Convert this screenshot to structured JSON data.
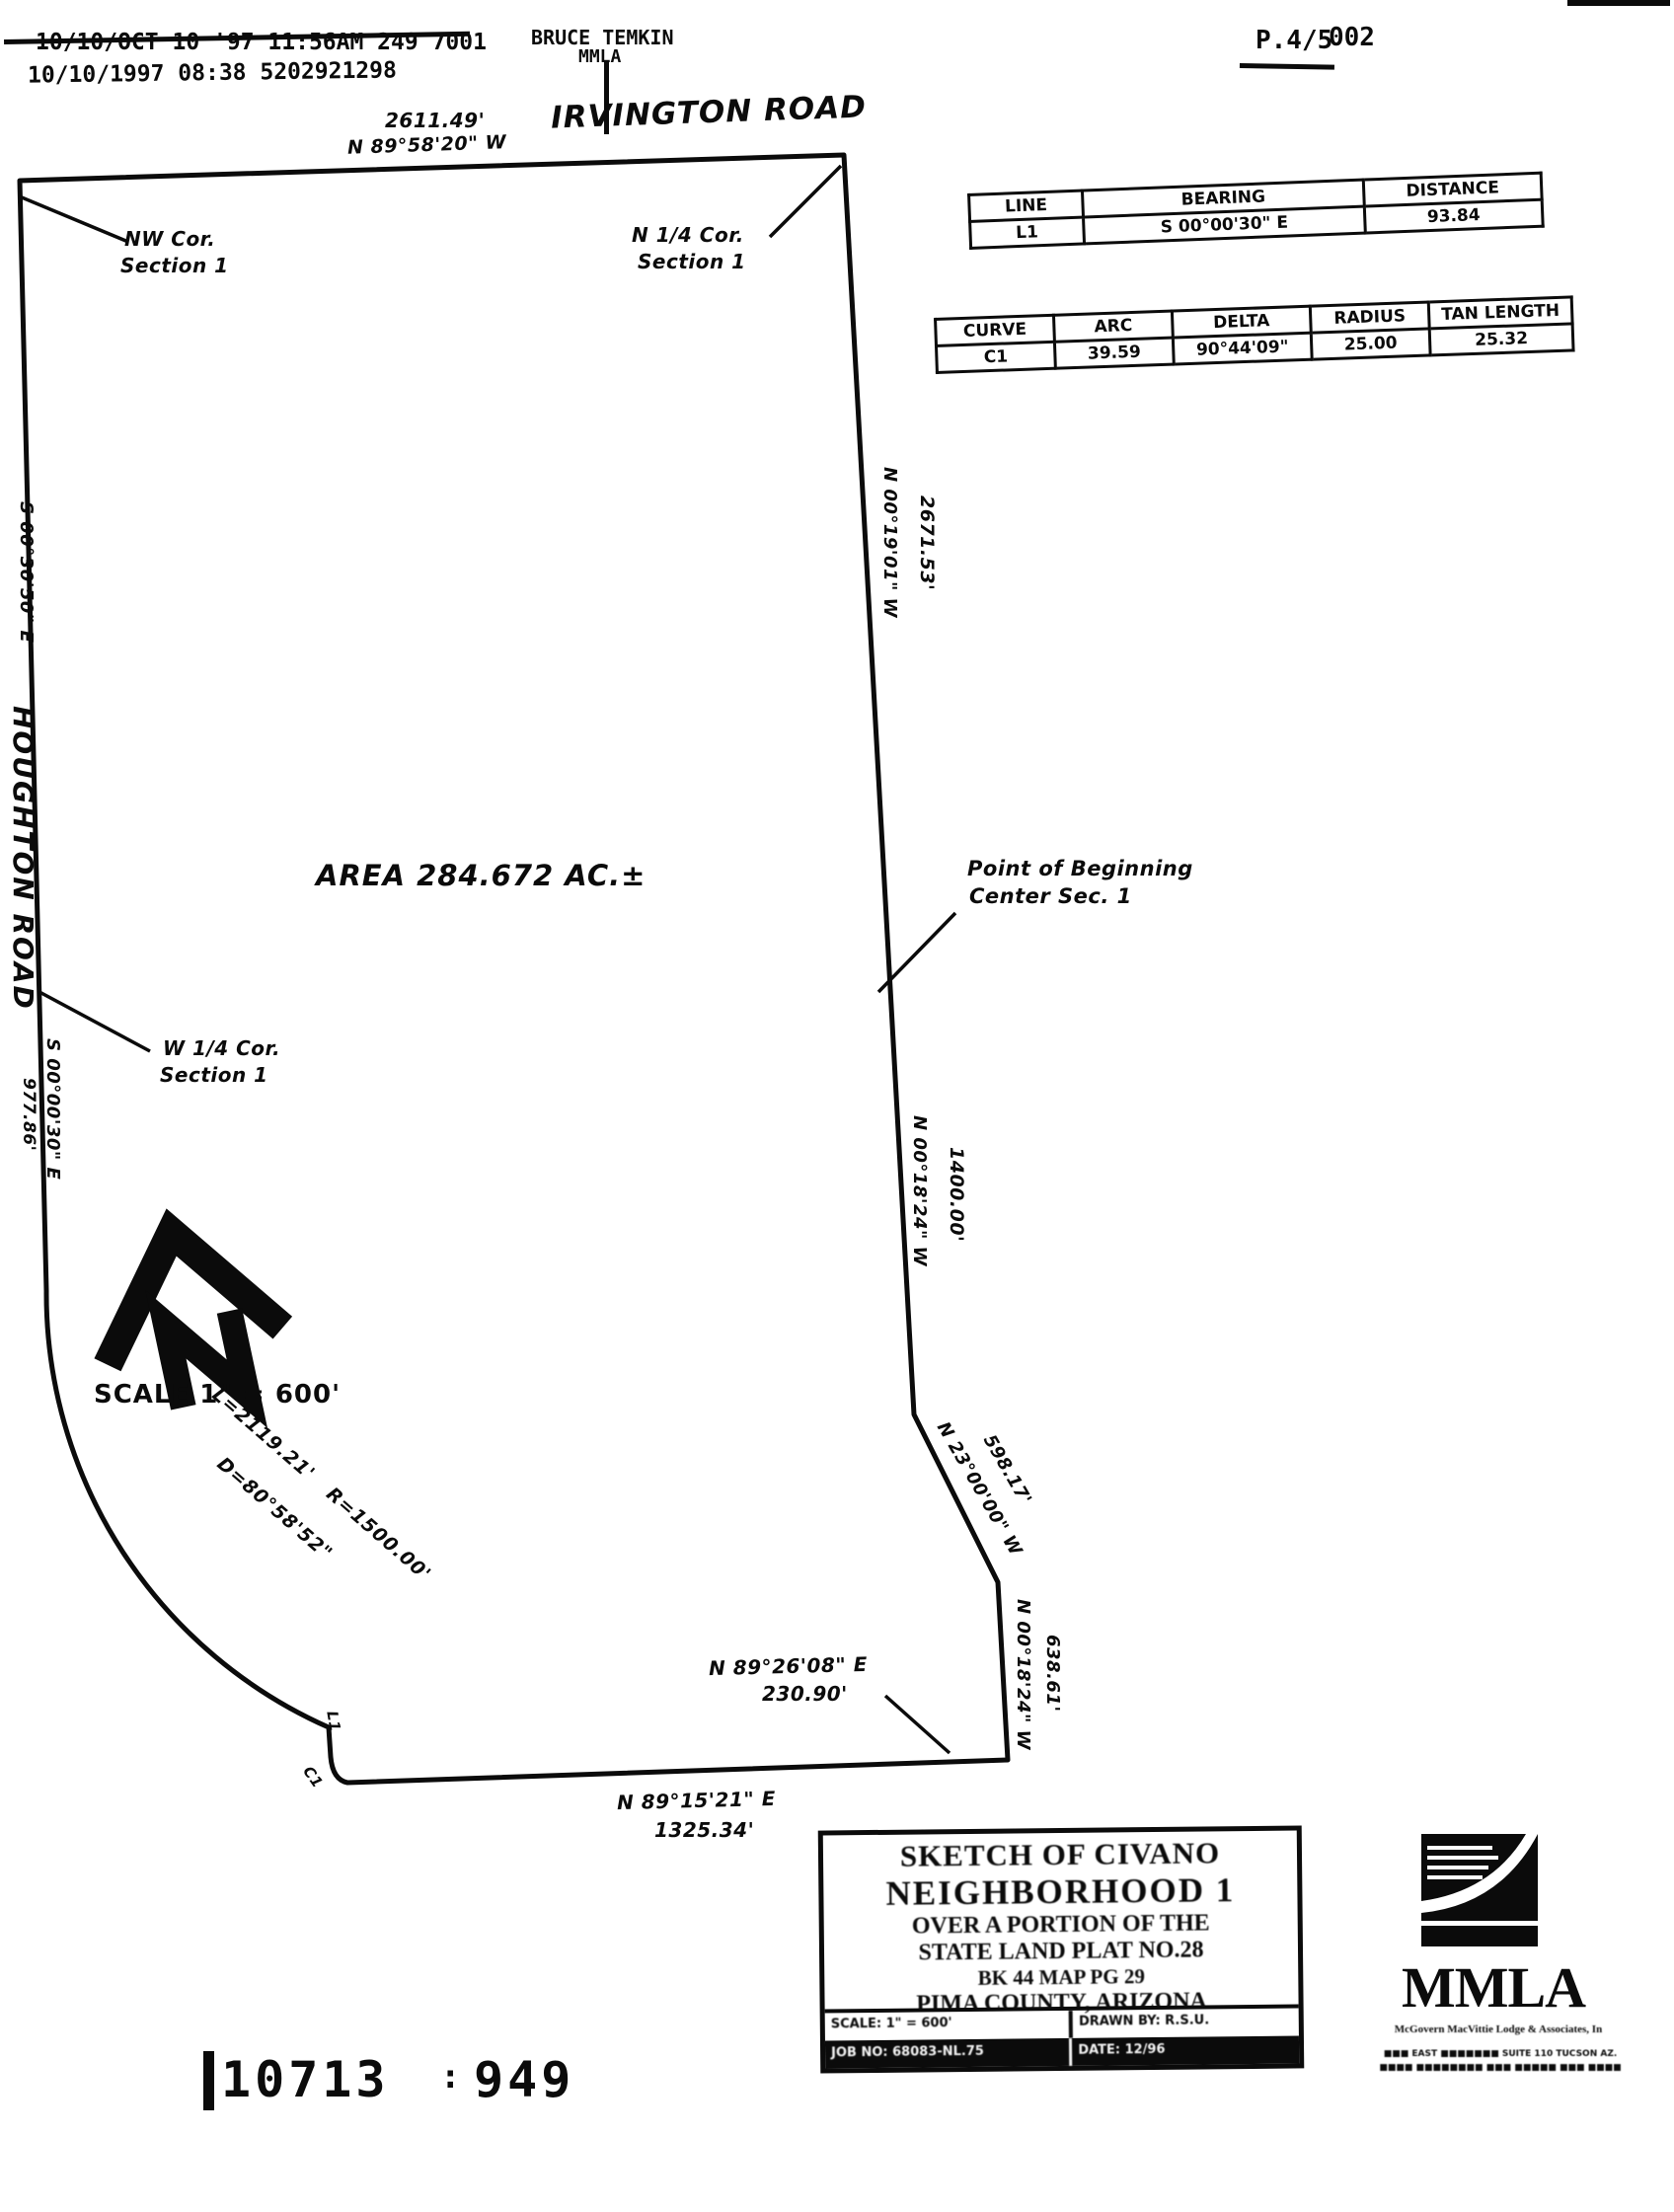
{
  "fax_header": {
    "line1": "10/10/OCT 10 '97  11:56AM 249 7001",
    "line2": "10/10/1997  08:38      5202921298",
    "sender_name": "BRUCE TEMKIN",
    "sender_org": "MMLA",
    "page_number": "P.4/5",
    "page_stamp": "002"
  },
  "plat": {
    "road_top": "IRVINGTON ROAD",
    "road_west": "HOUGHTON ROAD",
    "top_distance": "2611.49'",
    "top_bearing": "N 89°58'20\" W",
    "nw_corner_1": "NW Cor.",
    "nw_corner_2": "Section 1",
    "n_quarter_1": "N 1/4 Cor.",
    "n_quarter_2": "Section 1",
    "w_quarter_1": "W 1/4 Cor.",
    "w_quarter_2": "Section 1",
    "west_bearing_upper": "S 00°30'50\" E",
    "west_bearing_lower": "S 00°00'30\" E",
    "west_distance_lower": "977.86'",
    "area_label": "AREA 284.672 AC.±",
    "east_bearing_upper": "N 00°19'01\" W",
    "east_distance_upper": "2671.53'",
    "pob_1": "Point of Beginning",
    "pob_2": "Center Sec. 1",
    "east_bearing_mid": "N 00°18'24\" W",
    "east_distance_mid": "1400.00'",
    "diag_bearing": "N 23°00'00\" W",
    "diag_distance": "598.17'",
    "east_bearing_lower": "N 00°18'24\" W",
    "east_distance_lower": "638.61'",
    "south_bearing_1": "N 89°26'08\" E",
    "south_distance_1": "230.90'",
    "south_bearing_2": "N 89°15'21\" E",
    "south_distance_2": "1325.34'",
    "arc_length": "L=2119.21'",
    "arc_radius": "R=1500.00'",
    "arc_delta": "D=80°58'52\"",
    "ref_l1": "L1",
    "ref_c1": "C1"
  },
  "line_table": {
    "headers": [
      "LINE",
      "BEARING",
      "DISTANCE"
    ],
    "rows": [
      [
        "L1",
        "S 00°00'30\" E",
        "93.84"
      ]
    ]
  },
  "curve_table": {
    "headers": [
      "CURVE",
      "ARC",
      "DELTA",
      "RADIUS",
      "TAN LENGTH"
    ],
    "rows": [
      [
        "C1",
        "39.59",
        "90°44'09\"",
        "25.00",
        "25.32"
      ]
    ]
  },
  "north": {
    "letter": "N",
    "scale_label": "SCALE 1\" = 600'"
  },
  "title_block": {
    "line1": "SKETCH OF CIVANO",
    "line2": "NEIGHBORHOOD 1",
    "line3": "OVER A PORTION OF THE",
    "line4": "STATE LAND PLAT NO.28",
    "line5": "BK 44 MAP PG 29",
    "line6": "PIMA COUNTY, ARIZONA",
    "scale_cell": "SCALE: 1\" = 600'",
    "drawn_by_cell": "DRAWN BY: R.S.U.",
    "job_cell": "JOB NO: 68083-NL.75",
    "date_cell": "DATE: 12/96"
  },
  "mmla": {
    "name": "MMLA",
    "tagline": "McGovern MacVittie Lodge & Associates, In",
    "address1": "■■■ EAST ■■■■■■■ SUITE 110 TUCSON AZ.",
    "address2": "■■■■ ■■■■■■■■  ■■■ ■■■■■ ■■■ ■■■■"
  },
  "footer": {
    "number1": "10713",
    "sep": ":",
    "number2": "949"
  },
  "colors": {
    "ink": "#0b0b0b",
    "paper": "#ffffff"
  }
}
